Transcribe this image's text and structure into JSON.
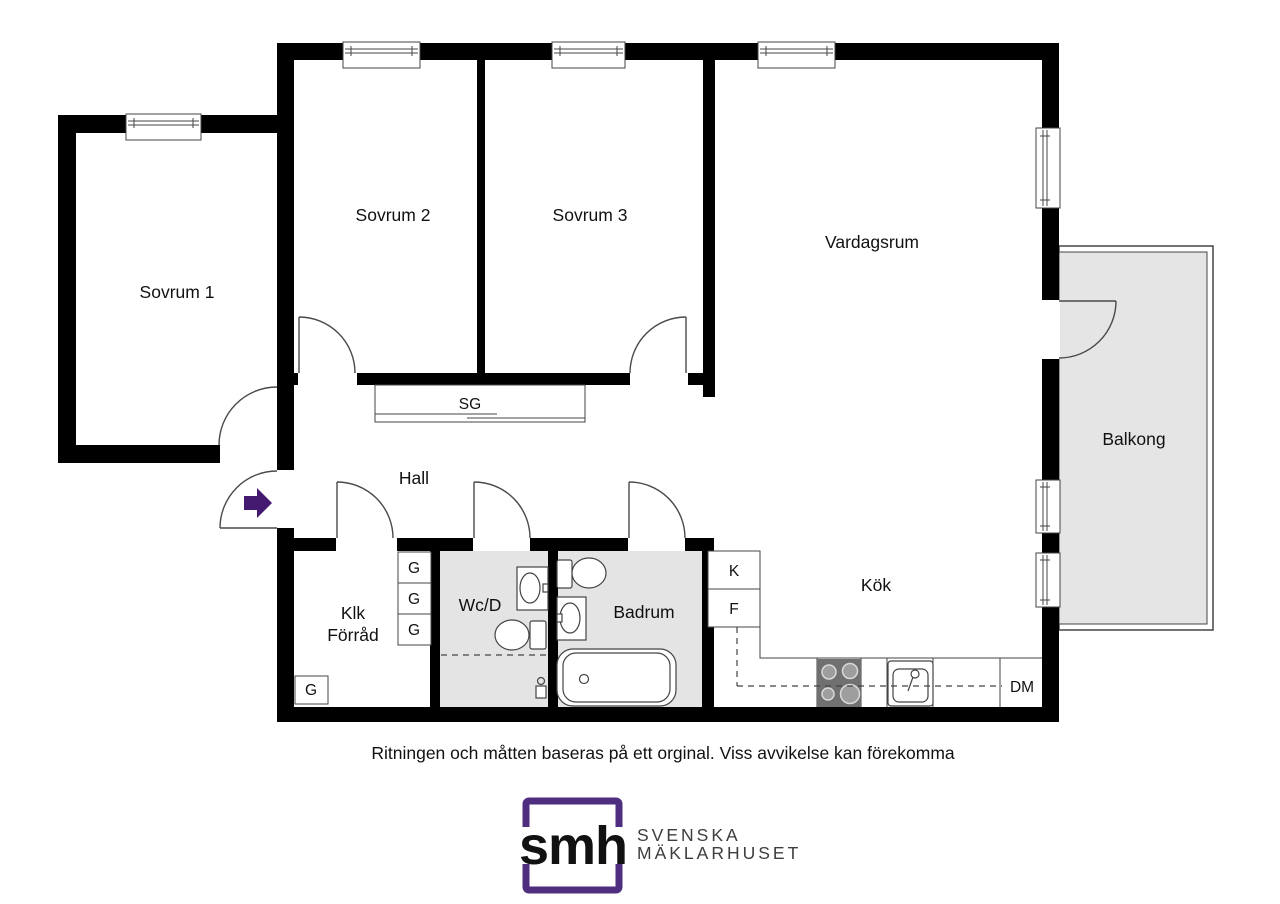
{
  "floorplan": {
    "room_labels": {
      "sovrum1": "Sovrum 1",
      "sovrum2": "Sovrum 2",
      "sovrum3": "Sovrum 3",
      "vardagsrum": "Vardagsrum",
      "balkong": "Balkong",
      "hall": "Hall",
      "klk_line1": "Klk",
      "klk_line2": "Förråd",
      "wcd": "Wc/D",
      "badrum": "Badrum",
      "kok": "Kök"
    },
    "feature_labels": {
      "sliding_wardrobe": "SG",
      "wardrobe": "G",
      "fridge": "K",
      "freezer": "F",
      "dishwasher": "DM"
    },
    "colors": {
      "wall": "#000000",
      "wet_room_fill": "#e4e4e4",
      "balcony_fill": "#e5e5e5",
      "thin_line": "#444444",
      "entry_arrow": "#441a70"
    }
  },
  "footer": {
    "disclaimer": "Ritningen och måtten baseras på ett orginal. Viss avvikelse kan förekomma"
  },
  "brand": {
    "monogram": "smh",
    "name_line1": "SVENSKA",
    "name_line2": "MÄKLARHUSET",
    "purple": "#4f2d7f",
    "text_color": "#3d3d3d"
  }
}
